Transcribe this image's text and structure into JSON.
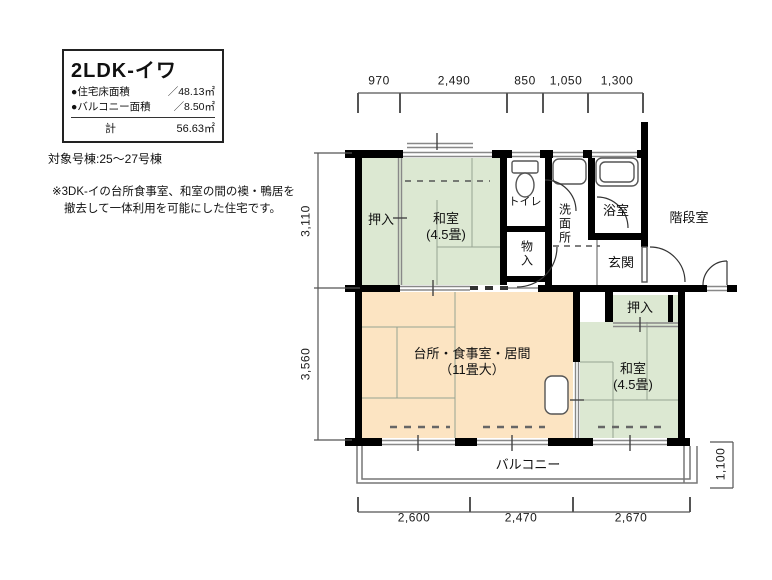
{
  "title_box": {
    "title": "2LDK-イワ",
    "rows": [
      {
        "label": "●住宅床面積",
        "value": "／48.13㎡"
      },
      {
        "label": "●バルコニー面積",
        "value": "／8.50㎡"
      }
    ],
    "total_label": "計",
    "total_value": "56.63㎡"
  },
  "target_building": "対象号棟:25〜27号棟",
  "note": {
    "line1": "※3DK-イの台所食事室、和室の間の襖・鴨居を",
    "line2": "撤去して一体利用を可能にした住宅です。"
  },
  "rooms": {
    "oshiire_left": "押入",
    "washitsu_top": {
      "name": "和室",
      "size": "(4.5畳)"
    },
    "toilet": "トイレ",
    "storage": "物入",
    "washroom": "洗面所",
    "bath": "浴室",
    "stairwell": "階段室",
    "entrance": "玄関",
    "oshiire_right": "押入",
    "washitsu_right": {
      "name": "和室",
      "size": "(4.5畳)"
    },
    "living": {
      "name": "台所・食事室・居間",
      "size": "（11畳大）"
    },
    "balcony": "バルコニー"
  },
  "dimensions": {
    "top": [
      "970",
      "2,490",
      "850",
      "1,050",
      "1,300"
    ],
    "left": [
      "3,110",
      "3,560"
    ],
    "bottom": [
      "2,600",
      "2,470",
      "2,670"
    ],
    "right": "1,100"
  },
  "colors": {
    "tatami_room": "#dce8d2",
    "living_room": "#fce4c2",
    "wall": "#000000"
  }
}
